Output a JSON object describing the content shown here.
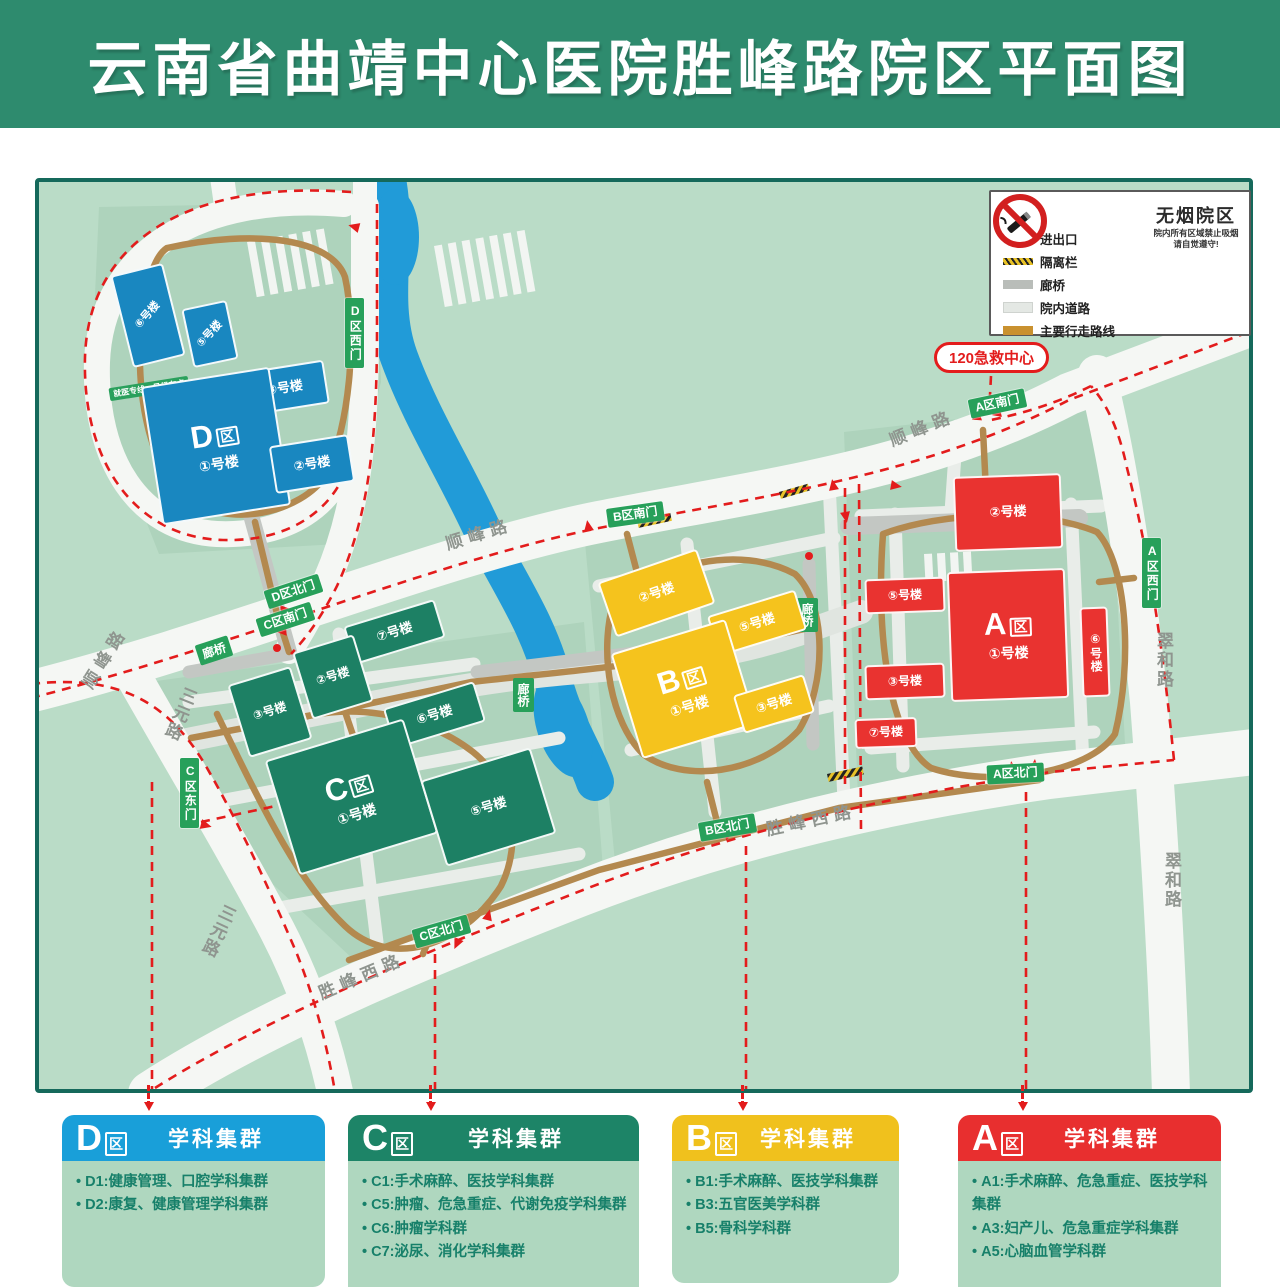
{
  "header": {
    "title": "云南省曲靖中心医院胜峰路院区平面图"
  },
  "map": {
    "legend": {
      "title": "图列",
      "items": [
        {
          "icon": "entrance-arrow",
          "label": "进出口"
        },
        {
          "icon": "barrier",
          "label": "隔离栏"
        },
        {
          "icon": "corridor",
          "label": "廊桥"
        },
        {
          "icon": "campus-road",
          "label": "院内道路"
        },
        {
          "icon": "walking-route",
          "label": "主要行走路线"
        }
      ]
    },
    "no_smoking": {
      "title": "无烟院区",
      "line1": "院内所有区域禁止吸烟",
      "line2": "请自觉遵守!"
    },
    "emergency_label": "120急救中心",
    "road_labels": [
      "顺峰路",
      "顺峰路",
      "顺峰路",
      "三元路",
      "三元路",
      "胜峰西路",
      "胜峰西路",
      "翠和路",
      "翠和路"
    ],
    "gates": [
      "D区西门",
      "D区北门",
      "C区南门",
      "C区东门",
      "C区北门",
      "B区南门",
      "B区北门",
      "A区南门",
      "A区西门",
      "A区北门"
    ],
    "corridor_labels": [
      "廊桥",
      "廊桥",
      "廊桥"
    ],
    "small_sign": "就医专线一号候车点",
    "zones": {
      "D": {
        "letter": "D",
        "qu": "区",
        "main_building": "①号楼",
        "buildings": [
          "⑥号楼",
          "⑤号楼",
          "③号楼",
          "②号楼"
        ]
      },
      "C": {
        "letter": "C",
        "qu": "区",
        "main_building": "①号楼",
        "buildings": [
          "⑦号楼",
          "②号楼",
          "③号楼",
          "⑥号楼",
          "⑤号楼"
        ]
      },
      "B": {
        "letter": "B",
        "qu": "区",
        "main_building": "①号楼",
        "buildings": [
          "②号楼",
          "⑤号楼",
          "③号楼"
        ]
      },
      "A": {
        "letter": "A",
        "qu": "区",
        "main_building": "①号楼",
        "buildings": [
          "②号楼",
          "⑤号楼",
          "③号楼",
          "⑥号楼",
          "⑦号楼"
        ]
      }
    },
    "colors": {
      "zone_d": "#1987c0",
      "zone_c": "#1d8064",
      "zone_b": "#f5c31d",
      "zone_a": "#e93330",
      "gate_green": "#27a05a",
      "route_red": "#e31c1c",
      "walk_brown": "#b3894f",
      "river_blue": "#219bd8",
      "header_green": "#2e8b6e"
    }
  },
  "cards": [
    {
      "letter": "D",
      "qu": "区",
      "title": "学科集群",
      "items": [
        "D1:健康管理、口腔学科集群",
        "D2:康复、健康管理学科集群"
      ]
    },
    {
      "letter": "C",
      "qu": "区",
      "title": "学科集群",
      "items": [
        "C1:手术麻醉、医技学科集群",
        "C5:肿瘤、危急重症、代谢免疫学科集群",
        "C6:肿瘤学科群",
        "C7:泌尿、消化学科集群"
      ]
    },
    {
      "letter": "B",
      "qu": "区",
      "title": "学科集群",
      "items": [
        "B1:手术麻醉、医技学科集群",
        "B3:五官医美学科群",
        "B5:骨科学科群"
      ]
    },
    {
      "letter": "A",
      "qu": "区",
      "title": "学科集群",
      "items": [
        "A1:手术麻醉、危急重症、医技学科集群",
        "A3:妇产儿、危急重症学科集群",
        "A5:心脑血管学科群"
      ]
    }
  ]
}
